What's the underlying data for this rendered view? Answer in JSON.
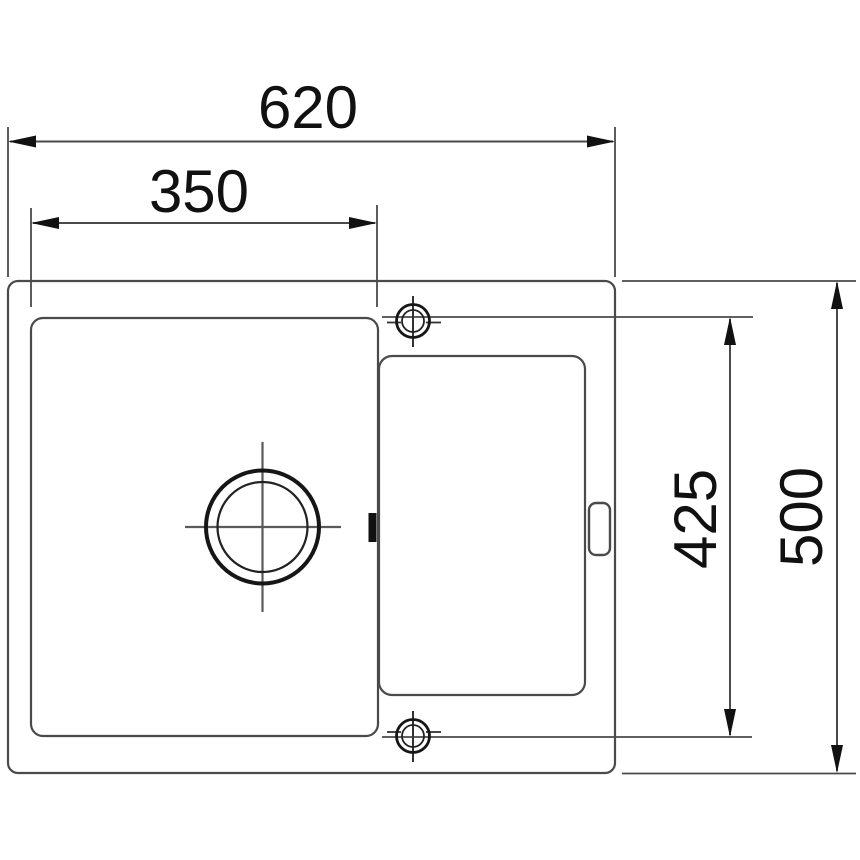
{
  "drawing": {
    "kind": "sink-technical-dimension-drawing",
    "view": "top-view",
    "labels": {
      "overall_width": "620",
      "bowl_width": "350",
      "inner_span": "425",
      "overall_depth": "500"
    },
    "components": {
      "outline": "sink-outer-edge",
      "bowl": "main-bowl",
      "drainboard": "drainer-area",
      "drain": "drain-hole-symbol",
      "tap_top": "tap-hole-top-symbol",
      "tap_bottom": "tap-hole-bottom-symbol",
      "overflow": "overflow-slot",
      "divider": "bowl-divider-mark"
    },
    "colors": {
      "line": "#4a4a4a",
      "thin_line": "#5a5a5a",
      "bold_line": "#161616",
      "arrow": "#111111",
      "text": "#111111",
      "background": "#ffffff"
    }
  }
}
